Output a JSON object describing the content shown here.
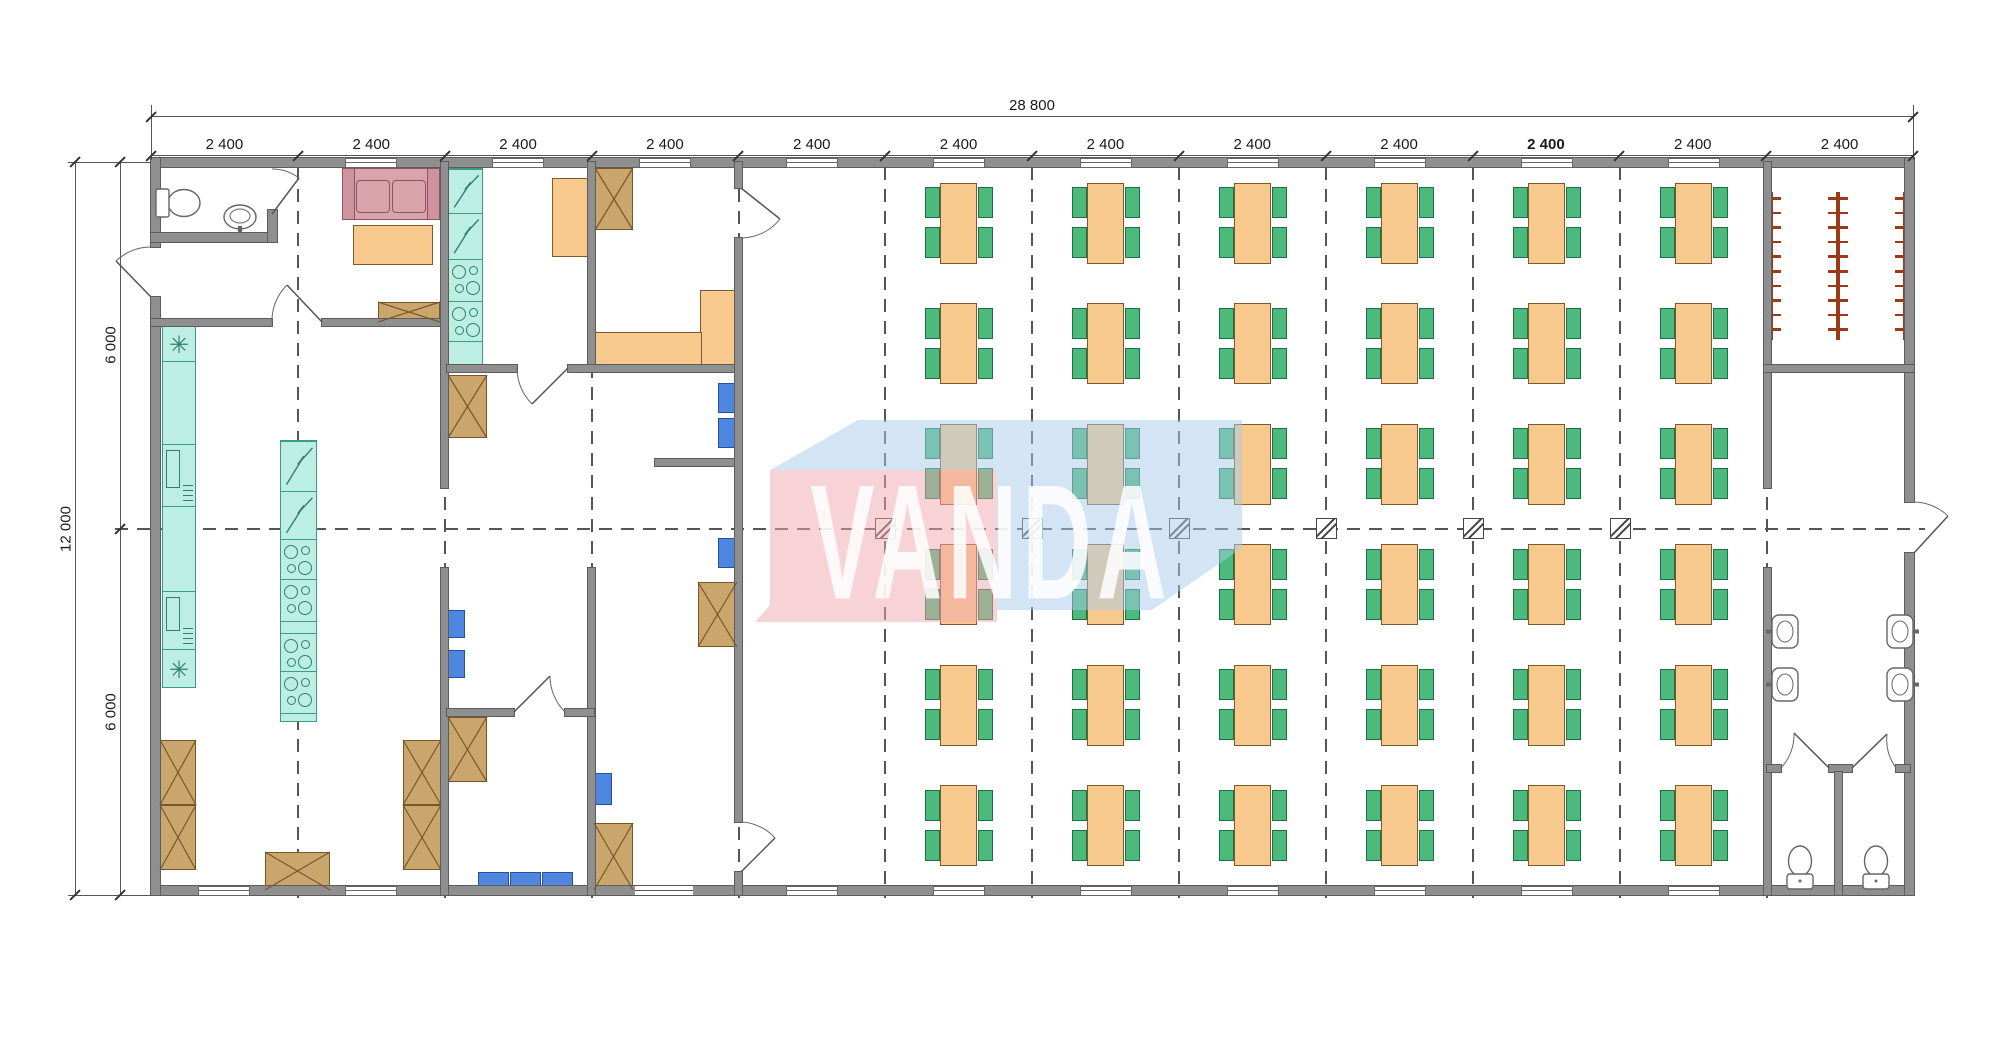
{
  "drawing": {
    "type": "architectural floor plan — canteen module building",
    "watermark": {
      "text": "VANDA",
      "pink": "rgba(240,168,178,0.5)",
      "blue": "rgba(168,203,233,0.5)"
    },
    "dimensions": {
      "top_total": {
        "label": "28 800"
      },
      "top_bays": {
        "label": "2 400",
        "count": 12,
        "emphasized_index": 9
      },
      "left_total": {
        "label": "12 000"
      },
      "left_segments": {
        "label": "6 000",
        "count": 2
      }
    },
    "dining_hall": {
      "table_columns": 6,
      "table_rows": 6,
      "tables": 36,
      "chairs_per_table": 4
    },
    "wardrobe": {
      "coat_racks": 3,
      "hooks_per_rack": 10
    },
    "washroom": {
      "wash_basins": 4,
      "wc_stalls": 2,
      "toilets": 2
    },
    "entry_wc": {
      "toilets": 1,
      "wash_basins": 1
    },
    "kitchen": {
      "blue_stools": 6,
      "blue_bench_seats": 3,
      "crates": 11,
      "cooker_modules": 6,
      "sofa_seats": 2
    },
    "colors": {
      "wall": "#8f8f8f",
      "table": "#f8c98d",
      "chair": "#4cba7d",
      "equipment_teal": "#bdeee3",
      "crate": "#cba66c",
      "sofa": "#d9a3ab",
      "stool_blue": "#4f86e0",
      "coat_rack": "#9a3a18",
      "grid_line": "#555555",
      "dimension_text": "#1a1a1a"
    }
  }
}
